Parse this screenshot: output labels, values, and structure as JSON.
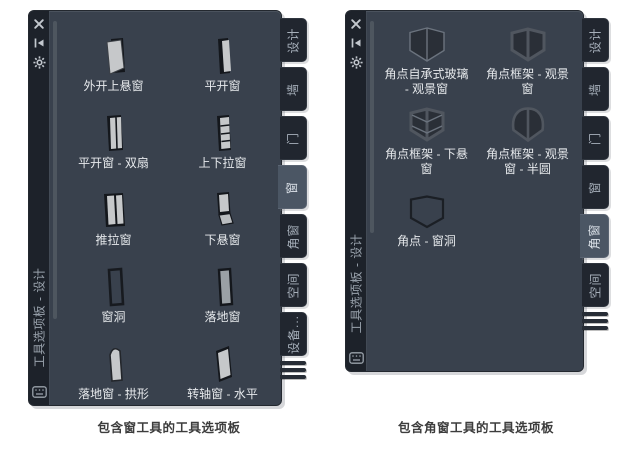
{
  "palettes": [
    {
      "title": "工具选项板 - 设计",
      "caption": "包含窗工具的工具选项板",
      "titlebar": {
        "close_icon": "close-icon",
        "autohide_icon": "autohide-pin-icon",
        "properties_icon": "gear-icon",
        "bottom_icon": "keyboard-icon"
      },
      "tabs": [
        {
          "label": "设计",
          "active": false
        },
        {
          "label": "墙",
          "active": false
        },
        {
          "label": "门",
          "active": false
        },
        {
          "label": "窗",
          "active": true
        },
        {
          "label": "角窗",
          "active": false
        },
        {
          "label": "空间",
          "active": false
        },
        {
          "label": "设备...",
          "active": false
        }
      ],
      "items": [
        {
          "label": "外开上悬窗",
          "icon": "top-hung-out-window-icon"
        },
        {
          "label": "平开窗",
          "icon": "casement-window-icon"
        },
        {
          "label": "平开窗 - 双扇",
          "icon": "casement-double-window-icon"
        },
        {
          "label": "上下拉窗",
          "icon": "double-hung-window-icon"
        },
        {
          "label": "推拉窗",
          "icon": "sliding-window-icon"
        },
        {
          "label": "下悬窗",
          "icon": "bottom-hung-window-icon"
        },
        {
          "label": "窗洞",
          "icon": "window-opening-icon"
        },
        {
          "label": "落地窗",
          "icon": "floor-window-icon"
        },
        {
          "label": "落地窗 - 拱形",
          "icon": "floor-window-arched-icon"
        },
        {
          "label": "转轴窗 - 水平",
          "icon": "pivot-window-horizontal-icon"
        }
      ]
    },
    {
      "title": "工具选项板 - 设计",
      "caption": "包含角窗工具的工具选项板",
      "titlebar": {
        "close_icon": "close-icon",
        "autohide_icon": "autohide-pin-icon",
        "properties_icon": "gear-icon",
        "bottom_icon": "keyboard-icon"
      },
      "tabs": [
        {
          "label": "设计",
          "active": false
        },
        {
          "label": "墙",
          "active": false
        },
        {
          "label": "门",
          "active": false
        },
        {
          "label": "窗",
          "active": false
        },
        {
          "label": "角窗",
          "active": true
        },
        {
          "label": "空间",
          "active": false
        }
      ],
      "items": [
        {
          "label": "角点自承式玻璃 - 观景窗",
          "icon": "corner-self-supporting-glass-window-icon"
        },
        {
          "label": "角点框架 - 观景窗",
          "icon": "corner-frame-picture-window-icon"
        },
        {
          "label": "角点框架 - 下悬窗",
          "icon": "corner-frame-bottom-hung-window-icon"
        },
        {
          "label": "角点框架 - 观景窗 - 半圆",
          "icon": "corner-frame-picture-window-semicircle-icon"
        },
        {
          "label": "角点 - 窗洞",
          "icon": "corner-window-opening-icon"
        }
      ]
    }
  ],
  "colors": {
    "palette_body": "#39414d",
    "titlebar_strip": "#1d222a",
    "tab": "#21262f",
    "tab_active": "#4b5664",
    "item_label": "#e6e9ec",
    "tab_label": "#a7b0bb",
    "caption_text": "#3d3d3d",
    "icon_frame": "#14171c",
    "icon_glass": "#c6c8ca"
  }
}
